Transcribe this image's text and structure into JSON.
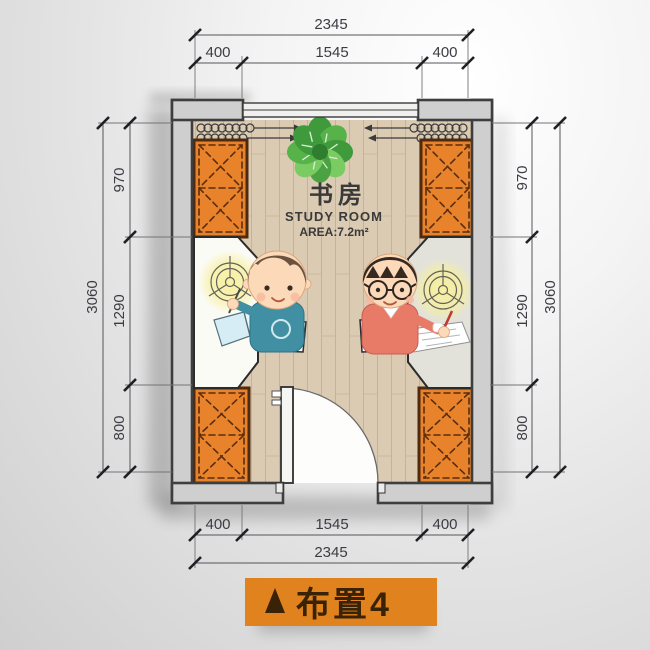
{
  "room": {
    "title_cn": "书房",
    "title_en": "STUDY ROOM",
    "area_label": "AREA:7.2m²"
  },
  "banner": {
    "label": "布置4",
    "triangle_icon": "▲",
    "bg_color": "#e0831e",
    "text_color": "#3a2206"
  },
  "dimensions": {
    "top": {
      "total": "2345",
      "segments": [
        "400",
        "1545",
        "400"
      ]
    },
    "bottom": {
      "total": "2345",
      "segments": [
        "400",
        "1545",
        "400"
      ]
    },
    "left": {
      "total": "3060",
      "segments": [
        "970",
        "1290",
        "800"
      ]
    },
    "right": {
      "total": "3060",
      "segments": [
        "970",
        "1290",
        "800"
      ]
    }
  },
  "icons": {
    "plant": "monstera-plant",
    "ceiling_light": "ceiling-light-symbol",
    "wardrobe": "crossed-wardrobe-cabinet",
    "curtain": "curtain-coil-arrow",
    "door": "door-quarter-swing",
    "window": "double-line-window"
  },
  "colors": {
    "wall_fill": "#d0cfcf",
    "wall_line": "#3f3e3e",
    "floor": "#dbcbb2",
    "cabinet": "#e8832c",
    "cabinet_border": "#4f2a0e",
    "desk_left": "#fbfbf6",
    "desk_right": "#e2e2db",
    "light_glow": "#f7ef9e",
    "plant_green": "#4aa243",
    "shirt_teal": "#418fa3",
    "sweater_salmon": "#e87a68",
    "dim_text": "#3c3c44"
  }
}
